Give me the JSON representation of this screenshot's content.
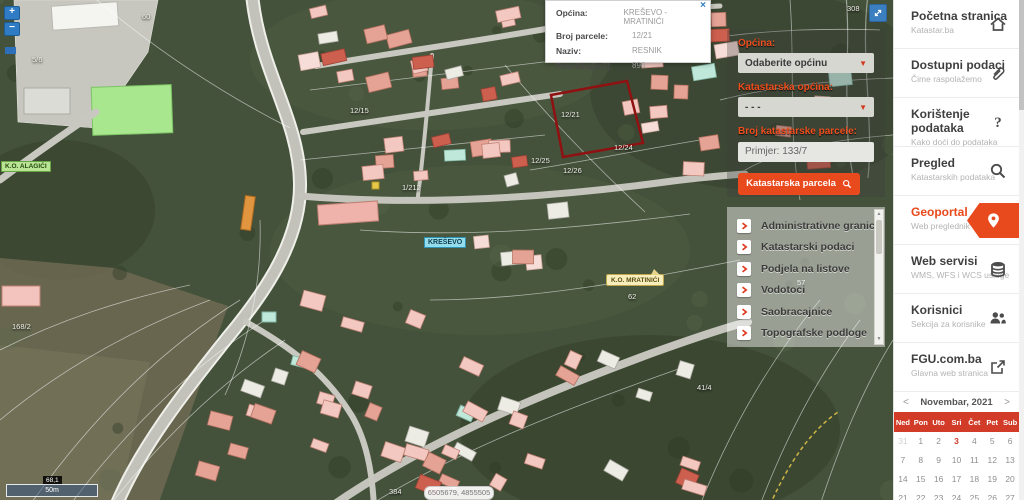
{
  "popup": {
    "close": "×",
    "rows": [
      {
        "label": "Općina:",
        "value": "KREŠEVO - MRATINIĆI"
      },
      {
        "label": "Broj parcele:",
        "value": "12/21"
      },
      {
        "label": "Naziv:",
        "value": "RESNIK"
      },
      {
        "label": "Površina[m2]:",
        "value": "896"
      }
    ]
  },
  "search_panel": {
    "municipality_label": "Općina:",
    "municipality_value": "Odaberite općinu",
    "cadastral_label": "Katastarska općina:",
    "cadastral_value": "- - -",
    "parcel_label": "Broj katastarske parcele:",
    "parcel_placeholder": "Primjer: 133/7",
    "search_button": "Katastarska parcela"
  },
  "layers_panel": {
    "items": [
      "Administrativne granice",
      "Katastarski podaci",
      "Podjela na listove",
      "Vodotoci",
      "Saobracajnice",
      "Topografske podloge"
    ]
  },
  "map": {
    "zoom_in": "+",
    "zoom_out": "−",
    "scale_readout": "68,1",
    "scale_bar": "50m",
    "coordinates": "6505679, 4855505",
    "place_label": "KREŠEVO",
    "ko_balloon": "K.O. MRATINIĆI",
    "ko_left_label": "K.O. ALAGIĆI",
    "parcel_labels": [
      {
        "text": "60",
        "x": 144,
        "y": 12
      },
      {
        "text": "5/6",
        "x": 34,
        "y": 55
      },
      {
        "text": "308",
        "x": 849,
        "y": 4
      },
      {
        "text": "12/15",
        "x": 352,
        "y": 106
      },
      {
        "text": "12/21",
        "x": 563,
        "y": 110
      },
      {
        "text": "12/24",
        "x": 616,
        "y": 143
      },
      {
        "text": "12/26",
        "x": 565,
        "y": 166
      },
      {
        "text": "12/25",
        "x": 533,
        "y": 156
      },
      {
        "text": "1/212",
        "x": 404,
        "y": 183
      },
      {
        "text": "168/2",
        "x": 14,
        "y": 322
      },
      {
        "text": "57",
        "x": 799,
        "y": 278
      },
      {
        "text": "62",
        "x": 630,
        "y": 292
      },
      {
        "text": "41/4",
        "x": 699,
        "y": 383
      },
      {
        "text": "384",
        "x": 391,
        "y": 487
      }
    ]
  },
  "sidebar": {
    "items": [
      {
        "title": "Početna stranica",
        "subtitle": "Katastar.ba",
        "icon": "home",
        "active": false
      },
      {
        "title": "Dostupni podaci",
        "subtitle": "Čime raspolažemo",
        "icon": "paperclip",
        "active": false
      },
      {
        "title": "Korištenje podataka",
        "subtitle": "Kako doći do podataka",
        "icon": "question",
        "active": false
      },
      {
        "title": "Pregled",
        "subtitle": "Katastarskih podataka",
        "icon": "magnifier",
        "active": false
      },
      {
        "title": "Geoportal",
        "subtitle": "Web preglednik",
        "icon": "pin",
        "active": true
      },
      {
        "title": "Web servisi",
        "subtitle": "WMS, WFS i WCS usluge",
        "icon": "stack",
        "active": false
      },
      {
        "title": "Korisnici",
        "subtitle": "Sekcija za korisnike",
        "icon": "users",
        "active": false
      },
      {
        "title": "FGU.com.ba",
        "subtitle": "Glavna web stranica",
        "icon": "external",
        "active": false
      }
    ]
  },
  "calendar": {
    "title": "Novembar, 2021",
    "prev": "<",
    "next": ">",
    "day_names": [
      "Ned",
      "Pon",
      "Uto",
      "Sri",
      "Čet",
      "Pet",
      "Sub"
    ],
    "weeks": [
      [
        "31",
        "1",
        "2",
        "3",
        "4",
        "5",
        "6"
      ],
      [
        "7",
        "8",
        "9",
        "10",
        "11",
        "12",
        "13"
      ],
      [
        "14",
        "15",
        "16",
        "17",
        "18",
        "19",
        "20"
      ],
      [
        "21",
        "22",
        "23",
        "24",
        "25",
        "26",
        "27"
      ]
    ],
    "muted_day": "31",
    "highlight_day": "3"
  },
  "colors": {
    "accent": "#e8491d",
    "calendar_header": "#d23b27",
    "selected_parcel_outline": "#8f1111",
    "map_button_blue": "#2f7cc4"
  }
}
